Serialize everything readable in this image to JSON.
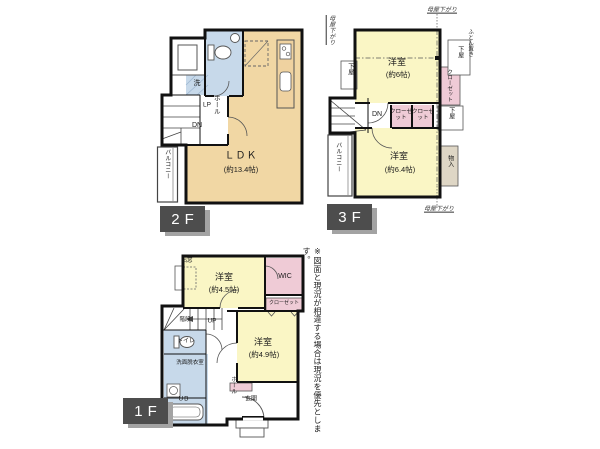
{
  "disclaimer": "※図面と現況が相違する場合は現況を優先とします。",
  "colors": {
    "ldk_tan": "#F1D7A4",
    "room_yellow": "#FAF6C5",
    "wet_area_blue": "#C7D9EA",
    "closet_pink": "#EFCBD6",
    "storage_khaki": "#DED6C5",
    "wall_black": "#111111",
    "floor_tag_bg": "#4D4D4D",
    "floor_tag_shadow": "#A3A3A3"
  },
  "floor2": {
    "label": "2F",
    "ldk_name": "ＬＤＫ",
    "ldk_size": "(約13.4帖)",
    "balcony": "バルコニー",
    "hall": "ホール",
    "dn": "DN",
    "lp": "LP",
    "laundry": "洗"
  },
  "floor3": {
    "label": "3F",
    "room1_name": "洋室",
    "room1_size": "(約6帖)",
    "room2_name": "洋室",
    "room2_size": "(約6.4帖)",
    "closet1": "クローゼット",
    "closet2": "クローゼット",
    "closet_side": "クローゼット",
    "geya_left": "下屋",
    "geya_top_right": "下屋",
    "geya_mid_right": "下屋",
    "moya_top": "母屋下がり",
    "moya_left": "母屋下がり",
    "moya_bottom": "母屋下がり",
    "futon": "ふとん置き",
    "storage": "物入",
    "balcony": "バルコニー",
    "dn": "DN"
  },
  "floor1": {
    "label": "1F",
    "room1_name": "洋室",
    "room1_size": "(約4.5帖)",
    "room2_name": "洋室",
    "room2_size": "(約4.9帖)",
    "wic": "WIC",
    "closet": "クローゼット",
    "bay_window": "出窓",
    "stairs": "階段",
    "up": "UP",
    "toilet": "トイレ",
    "washroom": "洗面脱衣室",
    "unit_bath": "UB",
    "hall": "ホール",
    "entrance": "玄関"
  }
}
